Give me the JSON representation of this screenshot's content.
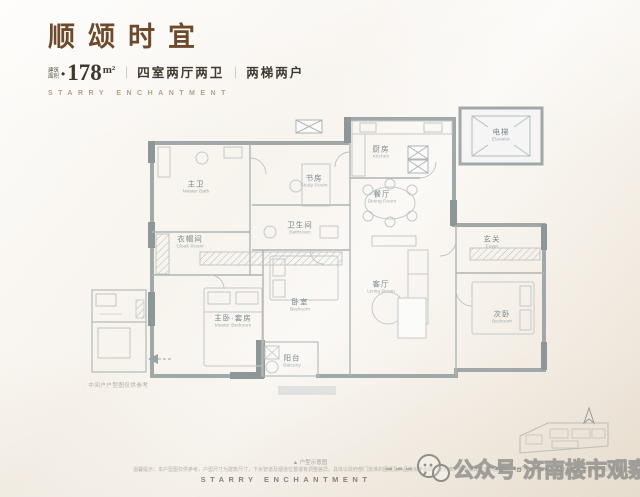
{
  "header": {
    "title": "顺颂时宜",
    "area_label_line1": "建筑",
    "area_label_line2": "面积",
    "area_bullet": "•",
    "area_value": "178",
    "area_unit": "m²",
    "sep": "｜",
    "spec1": "四室两厅两卫",
    "spec2": "两梯两户",
    "subtitle_en": "STARRY ENCHANTMENT"
  },
  "floorplan": {
    "caption": "▲ 户型示意图",
    "side_note": "· 中间户户型图仅供参考",
    "rooms": [
      {
        "id": "master-bath",
        "cn": "主卫",
        "en": "Master Bath"
      },
      {
        "id": "study",
        "cn": "书房",
        "en": "Study Room"
      },
      {
        "id": "bathroom",
        "cn": "卫生间",
        "en": "Bathroom"
      },
      {
        "id": "cloak",
        "cn": "衣帽间",
        "en": "Cloak Room"
      },
      {
        "id": "kitchen",
        "cn": "厨房",
        "en": "Kitchen"
      },
      {
        "id": "dining",
        "cn": "餐厅",
        "en": "Dining Room"
      },
      {
        "id": "living",
        "cn": "客厅",
        "en": "Living Room"
      },
      {
        "id": "foyer",
        "cn": "玄关",
        "en": "Foyer"
      },
      {
        "id": "master-bedroom",
        "cn": "主卧·套房",
        "en": "Master Bedroom"
      },
      {
        "id": "bedroom",
        "cn": "卧室",
        "en": "Bedroom"
      },
      {
        "id": "second-bedroom",
        "cn": "次卧",
        "en": "Bedroom"
      },
      {
        "id": "balcony",
        "cn": "阳台",
        "en": "Balcony"
      },
      {
        "id": "elevator",
        "cn": "电梯",
        "en": "Elevator"
      }
    ]
  },
  "footer": {
    "disclaimer": "温馨提示：本户型图仅供参考，户型尺寸为建筑尺寸，下水管道及烟道位置或有调整差异，具体以政府部门批准的图纸及商品房买卖合同约定为准，图中家具仅为示意展示，不作为交付标准，开发商保留对本资料的最终解释权。",
    "brand_en": "STARRY ENCHANTMENT",
    "watermark_text": "公众号·济南楼市观察"
  },
  "colors": {
    "brand_brown": "#6e4a2c",
    "tan_en": "#b7a183",
    "wall_gray": "#a0a8a8",
    "label_teal": "#76878a"
  }
}
